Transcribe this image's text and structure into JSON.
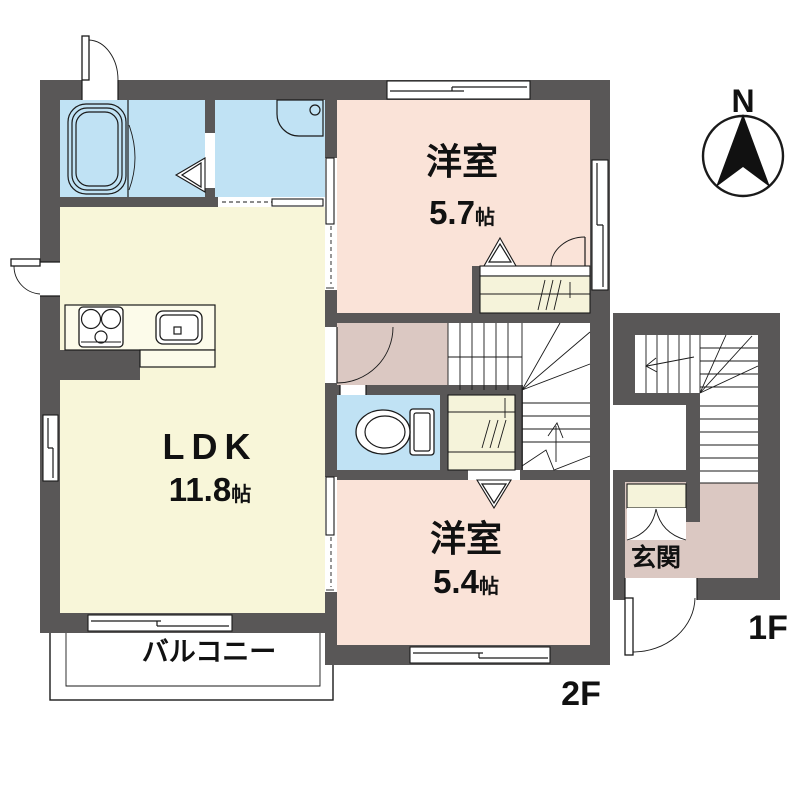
{
  "floorplan": {
    "compass": {
      "north_label": "N"
    },
    "rooms": {
      "bedroom_upper": {
        "label": "洋室",
        "size": "5.7",
        "size_unit": "帖"
      },
      "ldk": {
        "label": "LDK",
        "size": "11.8",
        "size_unit": "帖"
      },
      "bedroom_lower": {
        "label": "洋室",
        "size": "5.4",
        "size_unit": "帖"
      },
      "balcony": {
        "label": "バルコニー"
      },
      "entrance": {
        "label": "玄関"
      }
    },
    "floor_labels": {
      "second_floor": "2F",
      "first_floor": "1F"
    },
    "colors": {
      "wall": "#595757",
      "water_rooms": "#c0e2f4",
      "ldk_floor": "#f8f6d9",
      "bedroom_floor": "#fae3d8",
      "hall_floor": "#dbc8c2",
      "closet_floor": "#f5f3da",
      "counter": "#fcfbea",
      "outline": "#1a1a1a",
      "background": "#ffffff"
    }
  }
}
